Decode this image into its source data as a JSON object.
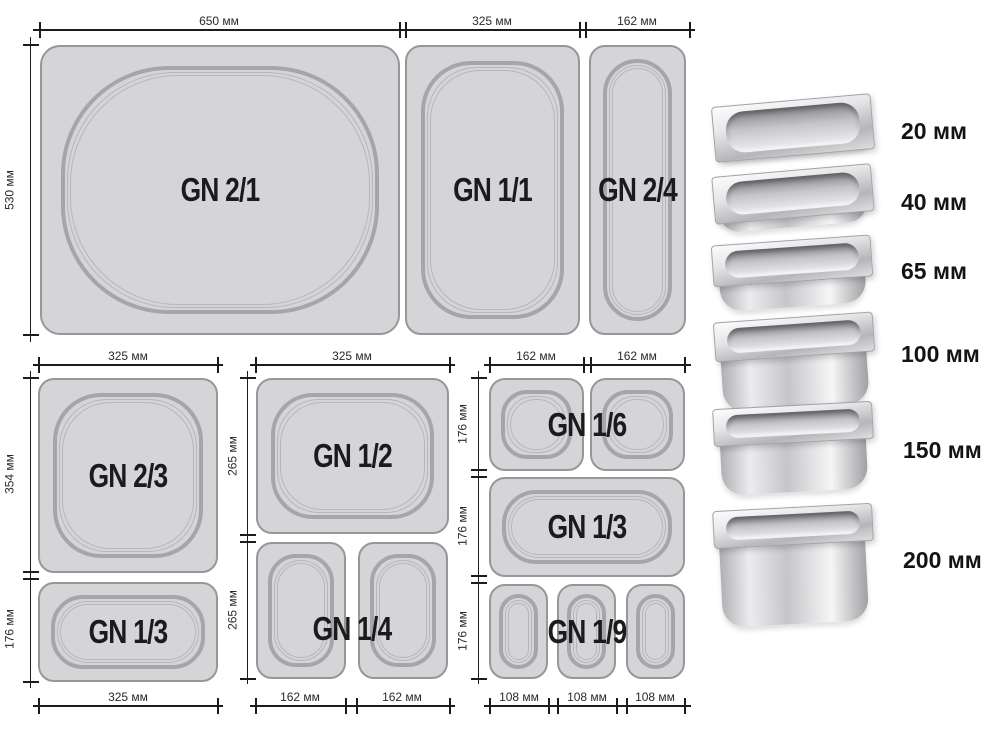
{
  "diagram": {
    "top": {
      "dim_650": "650 мм",
      "dim_325": "325 мм",
      "dim_162": "162 мм",
      "dim_530": "530 мм",
      "pan_21": "GN 2/1",
      "pan_11": "GN 1/1",
      "pan_24": "GN 2/4"
    },
    "left": {
      "dim_top": "325 мм",
      "dim_354": "354 мм",
      "dim_176": "176 мм",
      "dim_bottom": "325 мм",
      "pan_23": "GN 2/3",
      "pan_13": "GN 1/3"
    },
    "middle": {
      "dim_top": "325 мм",
      "dim_265_a": "265 мм",
      "dim_265_b": "265 мм",
      "dim_162_a": "162 мм",
      "dim_162_b": "162 мм",
      "pan_12": "GN 1/2",
      "pan_14": "GN 1/4"
    },
    "right": {
      "dim_top_a": "162 мм",
      "dim_top_b": "162 мм",
      "dim_176_a": "176 мм",
      "dim_176_b": "176 мм",
      "dim_176_c": "176 мм",
      "dim_108_a": "108 мм",
      "dim_108_b": "108 мм",
      "dim_108_c": "108 мм",
      "pan_16": "GN 1/6",
      "pan_13": "GN 1/3",
      "pan_19": "GN 1/9"
    }
  },
  "depths": {
    "d20": "20 мм",
    "d40": "40 мм",
    "d65": "65 мм",
    "d100": "100 мм",
    "d150": "150 мм",
    "d200": "200 мм"
  },
  "colors": {
    "pan_fill": "#d5d5d7",
    "pan_border": "#97979b",
    "well_stroke": "#a6a6a9",
    "line": "#1c1c1c",
    "text": "#1b1b1d",
    "background": "#ffffff"
  }
}
